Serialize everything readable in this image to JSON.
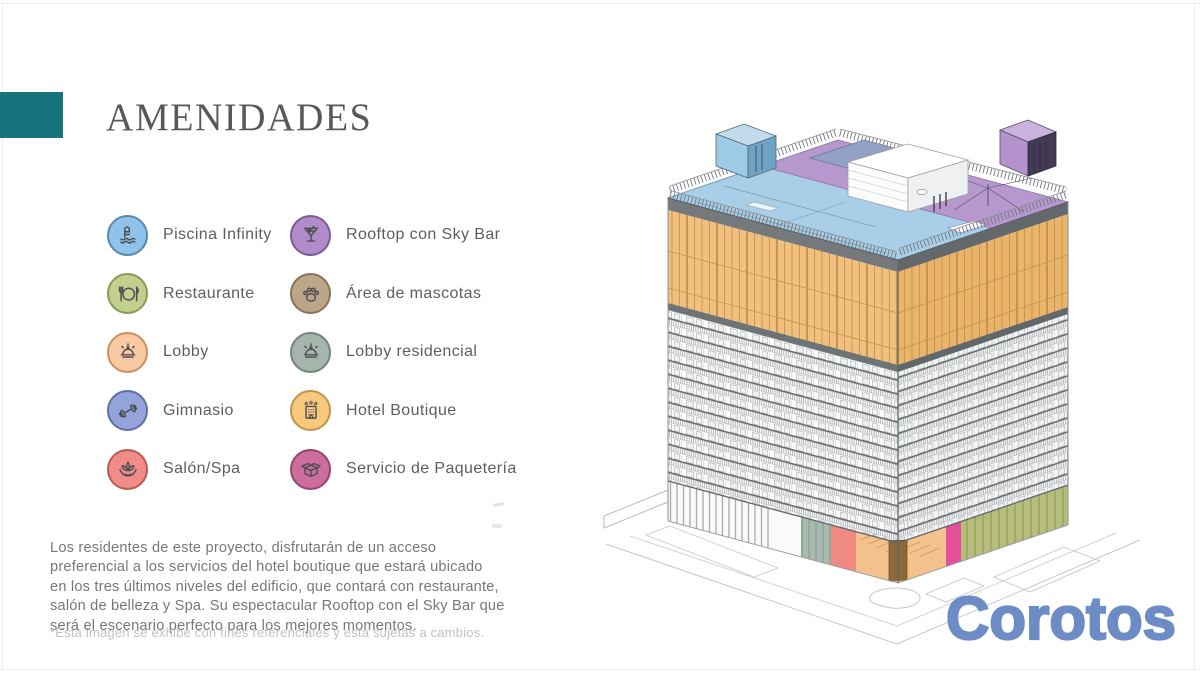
{
  "slide": {
    "title": "AMENIDADES",
    "description_lines": [
      "Los residentes de este proyecto, disfrutarán de un acceso",
      "preferencial a los servicios del hotel boutique que estará ubicado",
      "en los tres últimos niveles del edificio, que contará con restaurante,",
      "salón de belleza y Spa. Su espectacular Rooftop con el Sky Bar que",
      "será el escenario perfecto para los mejores momentos."
    ],
    "disclaimer": "*Esta imagen se exhibe con fines referenciales y está sujetas a cambios."
  },
  "accent_color": "#17747c",
  "watermark": {
    "text": "Corotos",
    "color": "#6d8cc6"
  },
  "amenities": [
    {
      "label": "Piscina Infinity",
      "icon": "pool-icon",
      "bg": "#8fc3e9",
      "border": "#5a87ab"
    },
    {
      "label": "Restaurante",
      "icon": "restaurant-icon",
      "bg": "#c2cf8e",
      "border": "#8a9a55"
    },
    {
      "label": "Lobby",
      "icon": "service-bell-icon",
      "bg": "#f9c9a2",
      "border": "#c98f62"
    },
    {
      "label": "Gimnasio",
      "icon": "dumbbell-icon",
      "bg": "#94a4d8",
      "border": "#5f6fa8"
    },
    {
      "label": "Salón/Spa",
      "icon": "lotus-icon",
      "bg": "#f18c88",
      "border": "#b85a57"
    },
    {
      "label": "Rooftop con Sky Bar",
      "icon": "cocktail-icon",
      "bg": "#b18cca",
      "border": "#7d5a96"
    },
    {
      "label": "Área de mascotas",
      "icon": "paw-icon",
      "bg": "#bca688",
      "border": "#8a7458"
    },
    {
      "label": "Lobby residencial",
      "icon": "service-bell-icon",
      "bg": "#a5b5ab",
      "border": "#72857b"
    },
    {
      "label": "Hotel Boutique",
      "icon": "hotel-icon",
      "bg": "#f6c97c",
      "border": "#c2934d"
    },
    {
      "label": "Servicio de Paquetería",
      "icon": "package-box-icon",
      "bg": "#cc6d9d",
      "border": "#96456e"
    }
  ],
  "building": {
    "colors": {
      "roof-blue": "#a8cfe7",
      "roof-purple": "#b697ce",
      "roof-slate": "#93a1c4",
      "bulkhead-blue": "#9ecbe5",
      "bulkhead-blue-dark": "#6fa3c4",
      "bulkhead-blue-top": "#c2dcec",
      "bulkhead-purple": "#b493cd",
      "bulkhead-purple-dark": "#433b54",
      "bulkhead-purple-top": "#cbb2dc",
      "hotel-orange": "#f2c07e",
      "hotel-orange-dark": "#eab46a",
      "mullion": "#c2924e",
      "parapet": "#75797c",
      "parapet-dark": "#63686b",
      "store-sage": "#a9bbb0",
      "store-coral": "#f0897f",
      "store-orange": "#f4c28d",
      "store-magenta": "#e44f9b",
      "store-olive": "#b6bd7b",
      "door-brown": "#8a6a3a",
      "street": "#c6c9cb"
    }
  }
}
